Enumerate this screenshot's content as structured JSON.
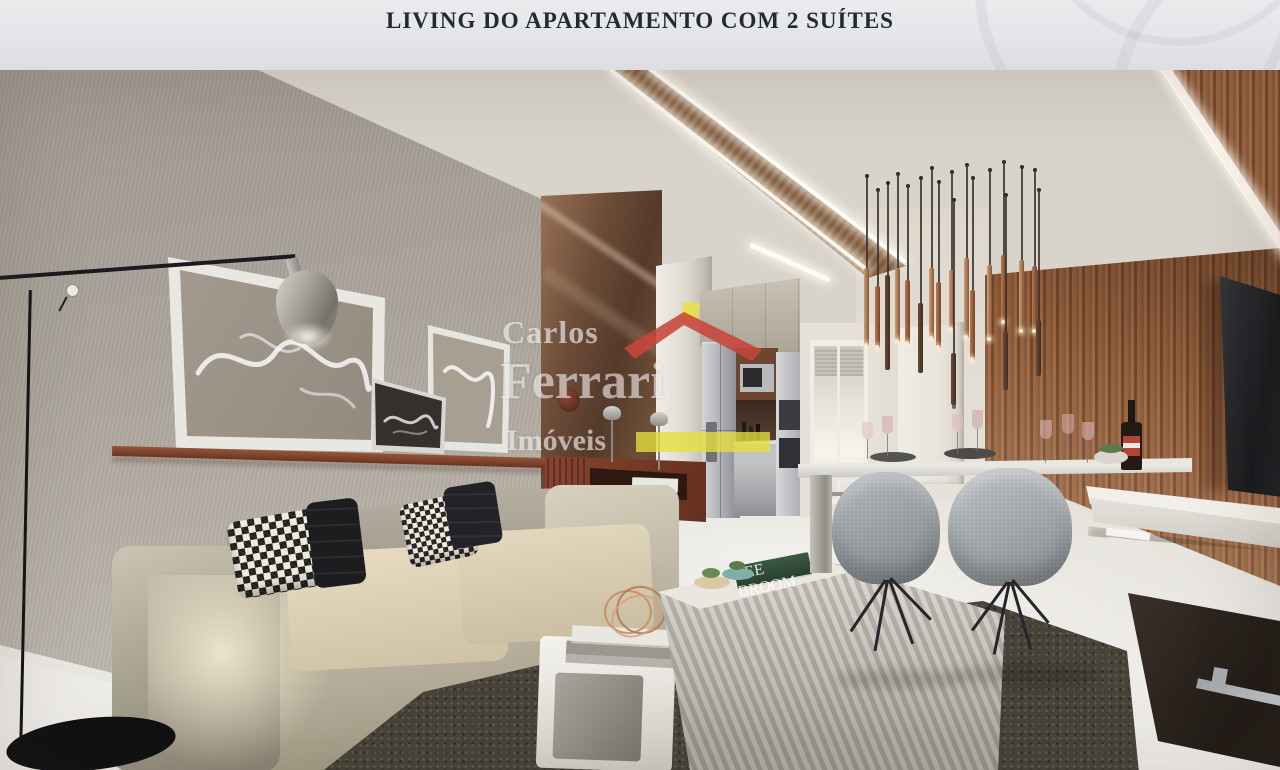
{
  "header": {
    "title": "LIVING DO APARTAMENTO COM 2 SUÍTES"
  },
  "watermark": {
    "top": "Carlos",
    "middle": "Ferrari",
    "bottom": "Imóveis",
    "roof_red": "#c7463a",
    "chimney_yellow": "#e8e23f",
    "bar_yellow": "#e6df3e"
  },
  "decor": {
    "green_book_spine": "LEE BROOM"
  }
}
